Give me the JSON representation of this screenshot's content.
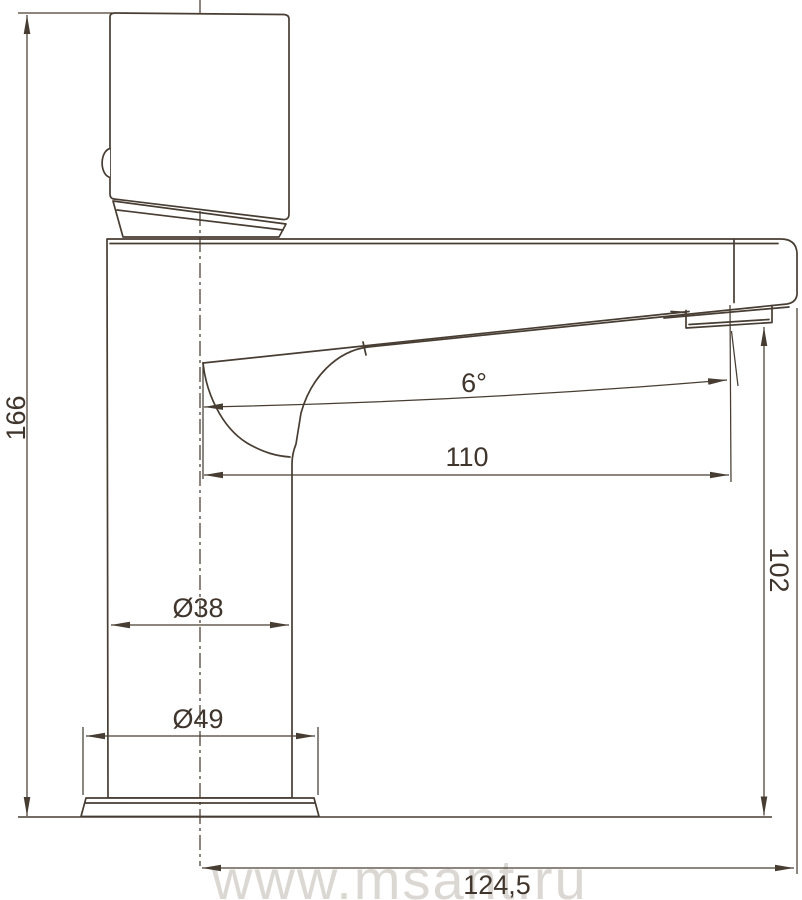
{
  "dimensions": {
    "total_height": "166",
    "spout_angle": "6°",
    "spout_reach": "110",
    "spout_height": "102",
    "body_diameter": "Ø38",
    "base_diameter": "Ø49",
    "total_depth": "124,5"
  },
  "watermark": "www.msant.ru",
  "colors": {
    "line": "#473d33",
    "label_text": "#3f352c",
    "watermark": "#dbd8d4",
    "background": "#ffffff"
  }
}
